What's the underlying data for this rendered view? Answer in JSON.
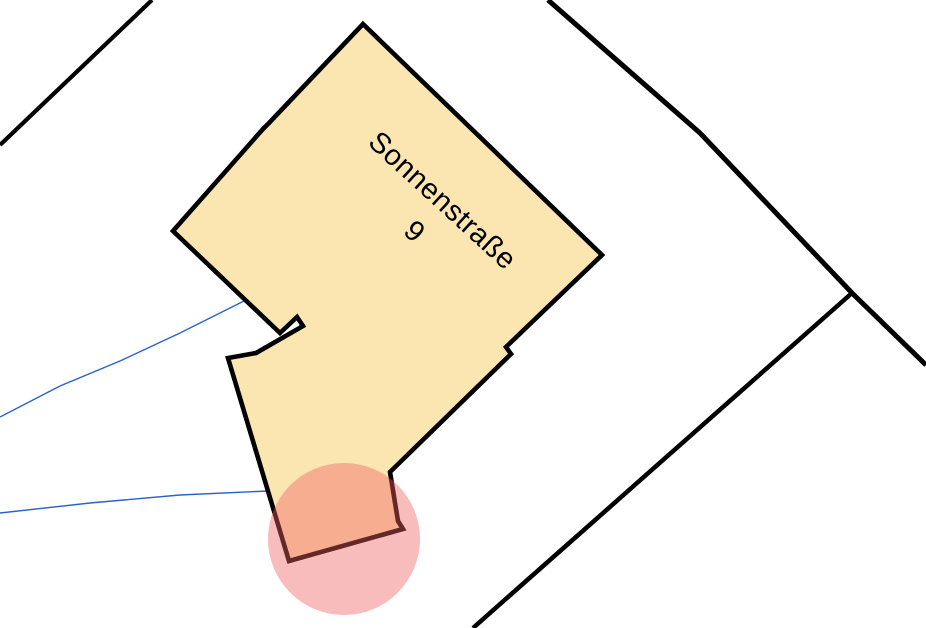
{
  "map": {
    "background_color": "#ffffff",
    "label": {
      "street": "Sonnenstraße",
      "number": "9",
      "color": "#000000",
      "font_size": 29,
      "rotation_deg": 42.5,
      "street_center": [
        443,
        200
      ],
      "number_center": [
        415,
        231
      ]
    },
    "building": {
      "fill": "#FBE5B1",
      "outline": "#000000",
      "outline_width": 4.6,
      "points": [
        [
          363,
          24
        ],
        [
          602,
          255
        ],
        [
          506,
          347
        ],
        [
          511,
          354
        ],
        [
          390,
          472
        ],
        [
          398,
          521
        ],
        [
          403,
          529
        ],
        [
          289,
          561
        ],
        [
          228,
          358
        ],
        [
          256,
          353
        ],
        [
          303,
          326
        ],
        [
          297,
          317
        ],
        [
          280,
          333
        ],
        [
          173,
          231
        ],
        [
          263,
          129
        ],
        [
          269,
          123
        ]
      ]
    },
    "boundary_lines": {
      "color": "#000000",
      "lines": [
        {
          "id": "parcel-line-top-left",
          "width": 4.2,
          "points": [
            [
              0,
              145
            ],
            [
              152,
              0
            ]
          ]
        },
        {
          "id": "parcel-line-main-road",
          "width": 5,
          "points": [
            [
              548,
              0
            ],
            [
              700,
              133
            ],
            [
              852,
              293
            ],
            [
              926,
              365
            ]
          ]
        },
        {
          "id": "parcel-line-branch",
          "width": 4.5,
          "points": [
            [
              852,
              293
            ],
            [
              473,
              628
            ]
          ]
        }
      ]
    },
    "utility_lines": {
      "color": "#2B62C8",
      "width": 1.4,
      "lines": [
        {
          "id": "blue-line-upper",
          "points": [
            [
              0,
              417
            ],
            [
              60,
              386
            ],
            [
              120,
              361
            ],
            [
              180,
              333
            ],
            [
              244,
              301
            ]
          ]
        },
        {
          "id": "blue-line-lower",
          "points": [
            [
              0,
              513
            ],
            [
              90,
              503
            ],
            [
              180,
              495
            ],
            [
              268,
              491
            ]
          ]
        }
      ]
    },
    "highlight": {
      "fill": "#F05F5F",
      "opacity": 0.42,
      "center": [
        344,
        539
      ],
      "radius": 76
    }
  }
}
